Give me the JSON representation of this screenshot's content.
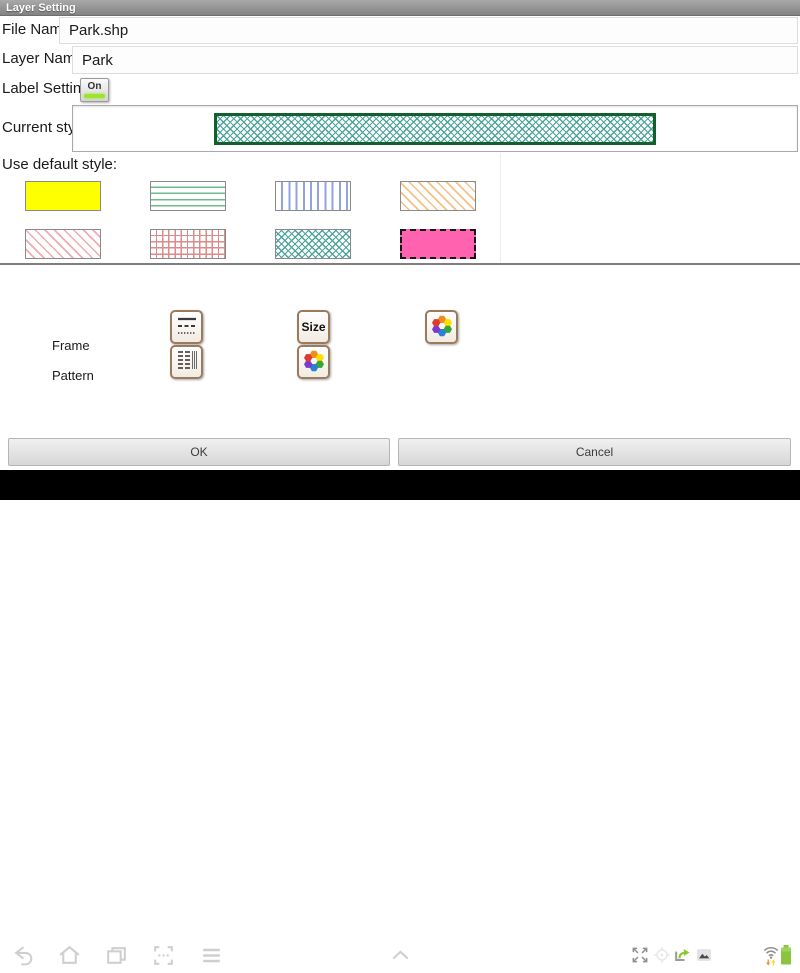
{
  "window": {
    "title": "Layer Setting"
  },
  "form": {
    "file_name_label": "File Name:",
    "file_name_value": "Park.shp",
    "layer_name_label": "Layer Name:",
    "layer_name_value": "Park",
    "label_setting_label": "Label Setting:",
    "label_setting_state": "On",
    "label_setting_on_color": "#9be52e",
    "current_style_label": "Current style:",
    "current_style": {
      "pattern": "teal-crosshatch",
      "border_color": "#14602c",
      "hatch_color": "#4ba49b"
    },
    "use_default_label": "Use default style:"
  },
  "default_styles": [
    {
      "name": "solid-yellow",
      "pattern": "sw-solid-yellow",
      "color": "#feff00"
    },
    {
      "name": "green-horizontal-lines",
      "pattern": "sw-hlines",
      "color": "#6dbd8a"
    },
    {
      "name": "blue-vertical-lines",
      "pattern": "sw-vlines",
      "color": "#93a3e2"
    },
    {
      "name": "orange-diagonal-hatch",
      "pattern": "sw-diag-orange",
      "color": "#f4c084"
    },
    {
      "name": "red-diagonal-hatch",
      "pattern": "sw-diag-red",
      "color": "#eeabb1"
    },
    {
      "name": "red-grid",
      "pattern": "sw-grid-red",
      "color": "#dc8a8a"
    },
    {
      "name": "teal-crosshatch",
      "pattern": "sw-crosshatch",
      "color": "#4ba49b"
    },
    {
      "name": "pink-dashed-border",
      "pattern": "sw-solid-pink",
      "color": "#ff63b0"
    }
  ],
  "style_editor": {
    "frame_label": "Frame",
    "pattern_label": "Pattern",
    "size_button_label": "Size",
    "buttons": [
      "frame-line-style-button",
      "pattern-style-button",
      "size-button",
      "pattern-color-button",
      "frame-color-button"
    ],
    "color_wheel_colors": [
      "#f08c1e",
      "#ffdf00",
      "#3aa435",
      "#2b7fd4",
      "#7a3bcc",
      "#e03a2f"
    ]
  },
  "actions": {
    "ok_label": "OK",
    "cancel_label": "Cancel"
  },
  "navbar": {
    "time": "16:52",
    "left_icons": [
      "back-icon",
      "home-icon",
      "recents-icon",
      "screenshot-icon",
      "menu-icon"
    ],
    "center_icon": "chevron-up-icon",
    "status_icons": [
      "fullscreen-icon",
      "location-icon",
      "sync-icon",
      "gallery-icon",
      "wifi-icon",
      "battery-icon"
    ],
    "battery_color": "#8bc43f",
    "wifi_down_arrow_color": "#f08c1e",
    "wifi_up_arrow_color": "#ffd61f"
  }
}
